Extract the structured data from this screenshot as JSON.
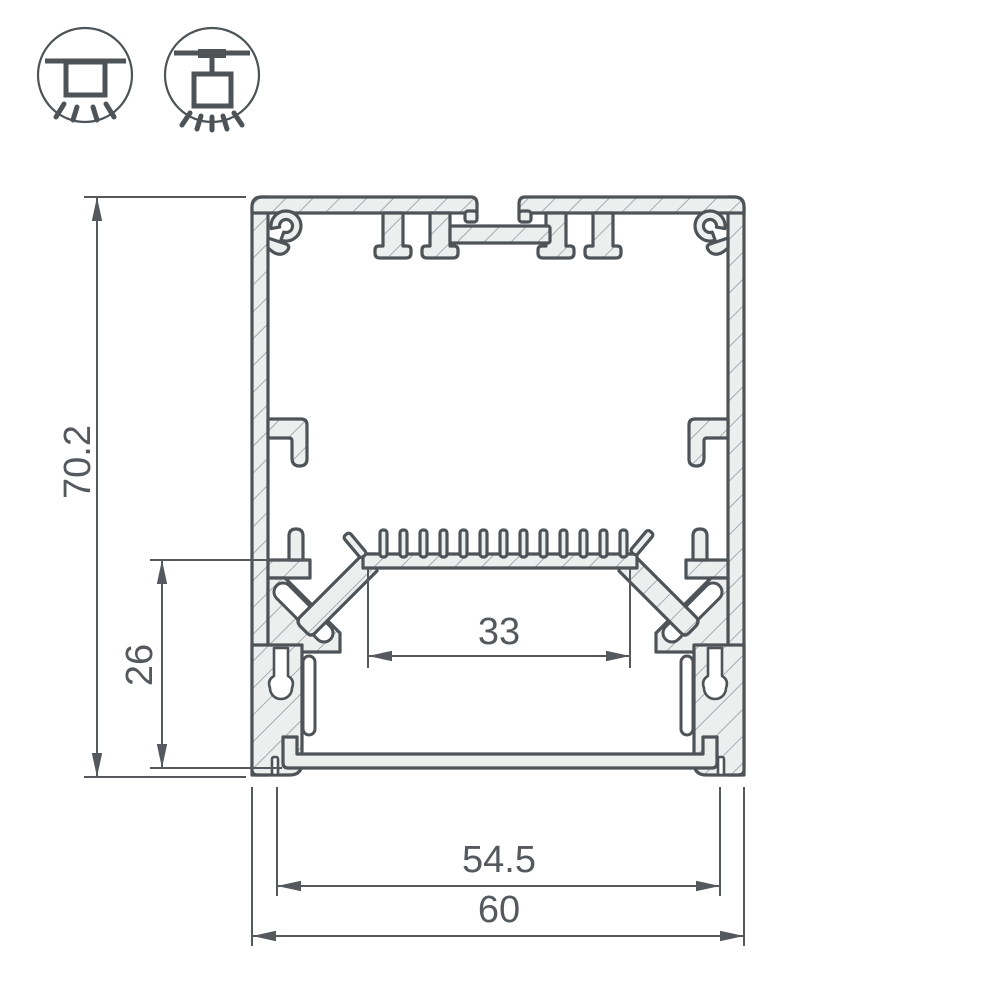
{
  "drawing": {
    "type": "aluminum-led-profile-cross-section",
    "dims": {
      "overall_height": "70.2",
      "inner_height": "26",
      "led_shelf_width": "33",
      "diffuser_width": "54.5",
      "overall_width": "60"
    },
    "icons": [
      {
        "name": "surface-mount-icon"
      },
      {
        "name": "pendant-mount-icon"
      }
    ]
  },
  "colors": {
    "outline": "#4E5357",
    "fill": "#EDEEEE",
    "hatch": "#9AA0A4",
    "dimension": "#55595D",
    "background": "#FFFFFF"
  }
}
